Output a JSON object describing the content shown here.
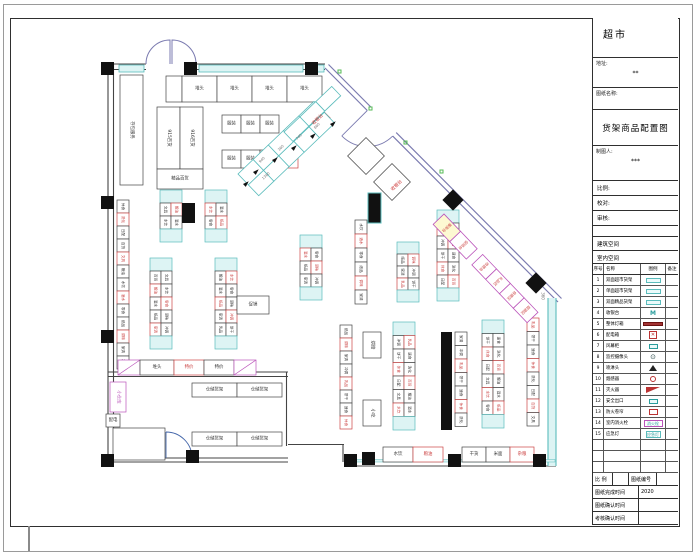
{
  "title_block": {
    "store_name": "超市",
    "address_label": "地址:",
    "address_value": "**",
    "drawing_name_label": "图纸名称:",
    "drawing_title": "货架商品配置图",
    "drafter_label": "制图人:",
    "drafter_value": "***",
    "scale_label": "比例:",
    "proof_label": "校对:",
    "review_label": "审核:",
    "building_label": "建筑空间",
    "interior_label": "室内空间"
  },
  "legend": {
    "headers": [
      "序号",
      "名称",
      "图例",
      "备注"
    ],
    "rows": [
      {
        "no": "1",
        "name": "双面超市货架",
        "sym": "pill-cyan",
        "symtext": ""
      },
      {
        "no": "2",
        "name": "单面超市货架",
        "sym": "pill-cyan",
        "symtext": ""
      },
      {
        "no": "3",
        "name": "双面精品货架",
        "sym": "pill-cyan",
        "symtext": ""
      },
      {
        "no": "4",
        "name": "收银台",
        "sym": "m-teal",
        "symtext": "M"
      },
      {
        "no": "5",
        "name": "整体灯箱",
        "sym": "bar-red",
        "symtext": ""
      },
      {
        "no": "6",
        "name": "配电箱",
        "sym": "box-red-x",
        "symtext": "✕"
      },
      {
        "no": "7",
        "name": "风幕柜",
        "sym": "pill-teal-sm",
        "symtext": ""
      },
      {
        "no": "8",
        "name": "监控摄像头",
        "sym": "cam",
        "symtext": "⊙"
      },
      {
        "no": "9",
        "name": "喷淋头",
        "sym": "tri-black",
        "symtext": ""
      },
      {
        "no": "10",
        "name": "烟感器",
        "sym": "circle-red",
        "symtext": ""
      },
      {
        "no": "11",
        "name": "灭火器",
        "sym": "flag-red",
        "symtext": ""
      },
      {
        "no": "12",
        "name": "安全出口",
        "sym": "pill-teal-sm",
        "symtext": ""
      },
      {
        "no": "13",
        "name": "防火卷帘",
        "sym": "box-red",
        "symtext": ""
      },
      {
        "no": "14",
        "name": "室内消火栓",
        "sym": "box-magenta",
        "symtext": "消火栓"
      },
      {
        "no": "15",
        "name": "应急灯",
        "sym": "box-cyan",
        "symtext": "应急灯"
      },
      {
        "no": "",
        "name": "",
        "sym": "none",
        "symtext": ""
      },
      {
        "no": "",
        "name": "",
        "sym": "none",
        "symtext": ""
      },
      {
        "no": "",
        "name": "",
        "sym": "none",
        "symtext": ""
      }
    ]
  },
  "footer": {
    "scale_label": "比 例",
    "sheet_no_label": "图纸编号",
    "rows": [
      {
        "label": "图纸完成时间",
        "value": "2020"
      },
      {
        "label": "图纸确认时间",
        "value": ""
      },
      {
        "label": "考核确认时间",
        "value": ""
      }
    ]
  },
  "plan": {
    "colors": {
      "wall": "#444444",
      "purple": "#7b7bb0",
      "cyan": "#5bbcbc",
      "cyan_fill": "#ddf4f4",
      "red": "#cc4444",
      "magenta": "#bb55bb",
      "black": "#111111",
      "green": "#55bb55",
      "yellow": "#fdf9d2",
      "dim": "#777777"
    },
    "label_pool": [
      "休食",
      "洗化",
      "日配",
      "百货",
      "文具",
      "粮油",
      "水饮",
      "酒水",
      "零食",
      "纸品",
      "调味",
      "家清",
      "冲调",
      "乳品",
      "饼干",
      "速食"
    ],
    "gondolas": [
      [
        117,
        200,
        1,
        13,
        12,
        13,
        0,
        0
      ],
      [
        160,
        190,
        2,
        4,
        11,
        13,
        1,
        2
      ],
      [
        205,
        190,
        2,
        4,
        11,
        13,
        1,
        4
      ],
      [
        150,
        258,
        2,
        7,
        11,
        13,
        1,
        1
      ],
      [
        215,
        258,
        2,
        7,
        11,
        13,
        1,
        3
      ],
      [
        300,
        235,
        2,
        5,
        11,
        13,
        1,
        5
      ],
      [
        355,
        220,
        1,
        6,
        12,
        14,
        0,
        6
      ],
      [
        397,
        242,
        2,
        5,
        11,
        12,
        1,
        7
      ],
      [
        437,
        210,
        2,
        7,
        11,
        13,
        1,
        8
      ],
      [
        340,
        325,
        1,
        8,
        12,
        13,
        0,
        9
      ],
      [
        393,
        322,
        2,
        8,
        11,
        13.5,
        1,
        10
      ],
      [
        455,
        332,
        1,
        7,
        12,
        13.5,
        0,
        11
      ],
      [
        482,
        320,
        2,
        8,
        11,
        13.5,
        1,
        12
      ],
      [
        527,
        318,
        1,
        8,
        12,
        13.5,
        0,
        13
      ]
    ],
    "rooms": [
      [
        157,
        107,
        23,
        62,
        "915百货",
        90,
        "#444"
      ],
      [
        180,
        107,
        23,
        62,
        "916百货",
        90,
        "#444"
      ],
      [
        157,
        169,
        46,
        20,
        "精品百货",
        0,
        "#444"
      ],
      [
        120,
        75,
        23,
        110,
        "存包服务",
        90,
        "#444"
      ],
      [
        110,
        382,
        16,
        30,
        "小仓库",
        90,
        "#bb55bb"
      ],
      [
        106,
        414,
        14,
        13,
        "配电",
        0,
        "#444"
      ],
      [
        113,
        428,
        52,
        32,
        "",
        0,
        "#444"
      ],
      [
        237,
        296,
        32,
        18,
        "促销",
        0,
        "#444"
      ],
      [
        363,
        332,
        18,
        26,
        "烘焙",
        90,
        "#444"
      ],
      [
        363,
        400,
        18,
        26,
        "小吃",
        90,
        "#444"
      ]
    ],
    "cell_rows": [
      {
        "x": 166,
        "y": 76,
        "h": 26,
        "cells": [
          [
            16,
            "",
            0
          ],
          [
            35,
            "堆头",
            0
          ],
          [
            35,
            "堆头",
            0
          ],
          [
            35,
            "堆头",
            0
          ],
          [
            35,
            "堆头",
            0
          ]
        ]
      },
      {
        "x": 222,
        "y": 115,
        "h": 18,
        "cells": [
          [
            19,
            "服装",
            0
          ],
          [
            19,
            "服装",
            0
          ],
          [
            19,
            "服装",
            0
          ]
        ]
      },
      {
        "x": 222,
        "y": 150,
        "h": 18,
        "cells": [
          [
            19,
            "服装",
            0
          ],
          [
            19,
            "服装",
            0
          ],
          [
            19,
            "服装",
            0
          ],
          [
            19,
            "服装",
            2
          ]
        ]
      },
      {
        "x": 118,
        "y": 360,
        "h": 15,
        "cells": [
          [
            22,
            "",
            1
          ],
          [
            34,
            "堆头",
            0
          ],
          [
            30,
            "特价",
            2
          ],
          [
            30,
            "特价",
            0
          ],
          [
            22,
            "",
            1
          ]
        ]
      },
      {
        "x": 192,
        "y": 383,
        "h": 14,
        "cells": [
          [
            45,
            "仓储货架",
            0
          ],
          [
            45,
            "仓储货架",
            0
          ]
        ]
      },
      {
        "x": 192,
        "y": 432,
        "h": 14,
        "cells": [
          [
            45,
            "仓储货架",
            0
          ],
          [
            45,
            "仓储货架",
            0
          ]
        ]
      },
      {
        "x": 383,
        "y": 447,
        "h": 15,
        "cells": [
          [
            30,
            "水饮",
            0
          ],
          [
            30,
            "粮油",
            2
          ]
        ]
      },
      {
        "x": 462,
        "y": 447,
        "h": 15,
        "cells": [
          [
            24,
            "干货",
            0
          ],
          [
            24,
            "米面",
            0
          ],
          [
            24,
            "杂粮",
            2
          ]
        ]
      }
    ],
    "columns": [
      [
        101,
        62
      ],
      [
        184,
        62
      ],
      [
        305,
        62
      ],
      [
        101,
        196
      ],
      [
        101,
        330
      ],
      [
        344,
        454
      ],
      [
        362,
        452
      ],
      [
        448,
        454
      ],
      [
        533,
        454
      ],
      [
        101,
        454
      ],
      [
        186,
        450
      ]
    ],
    "bars": [
      [
        441,
        332,
        11,
        98
      ],
      [
        182,
        203,
        13,
        20
      ]
    ],
    "freezers": [
      [
        368,
        193,
        13,
        30
      ]
    ],
    "diamonds": [
      [
        453,
        200
      ],
      [
        536,
        283
      ]
    ],
    "white_diamonds": [
      [
        366,
        156,
        26
      ],
      [
        392,
        182,
        26
      ]
    ],
    "red_diamond": [
      316,
      118,
      20
    ],
    "checkout": {
      "x": 238,
      "y": 174,
      "rot": -43.7,
      "cols": 5,
      "rows": 2,
      "cw": 21,
      "ch": 15
    },
    "chain": {
      "x": 284,
      "y": 132,
      "rot": -43.7,
      "cols": 3,
      "rows": 1,
      "cw": 22,
      "ch": 13
    },
    "diag_shelves": {
      "x": 444,
      "y": 214,
      "rot": 46.3,
      "h": 15,
      "cells": [
        [
          24,
          "服务台",
          1
        ],
        [
          24,
          "促销台",
          0
        ],
        [
          -8,
          "",
          0
        ],
        [
          20,
          "收银台",
          0
        ],
        [
          20,
          "礼品区",
          0
        ],
        [
          20,
          "自提区",
          0
        ],
        [
          20,
          "烟酒区",
          0
        ]
      ]
    },
    "texts": [
      [
        318,
        120,
        "收银台",
        "#cc3333",
        4.5,
        -44
      ],
      [
        397,
        186,
        "收银台",
        "#cc3333",
        4.5,
        -44
      ],
      [
        543,
        296,
        "360",
        "#777777",
        4,
        90
      ]
    ],
    "dims": [
      [
        262,
        160,
        "940"
      ],
      [
        281,
        148,
        "360"
      ],
      [
        299,
        137,
        "740"
      ],
      [
        317,
        126,
        "860"
      ],
      [
        266,
        176,
        "1360"
      ]
    ],
    "arrows": [
      [
        253,
        172
      ],
      [
        272,
        160
      ],
      [
        291,
        148
      ],
      [
        310,
        136
      ],
      [
        330,
        124
      ],
      [
        243,
        184
      ]
    ],
    "greens": [
      [
        338,
        70
      ],
      [
        369,
        107
      ],
      [
        404,
        141
      ],
      [
        440,
        170
      ]
    ]
  }
}
